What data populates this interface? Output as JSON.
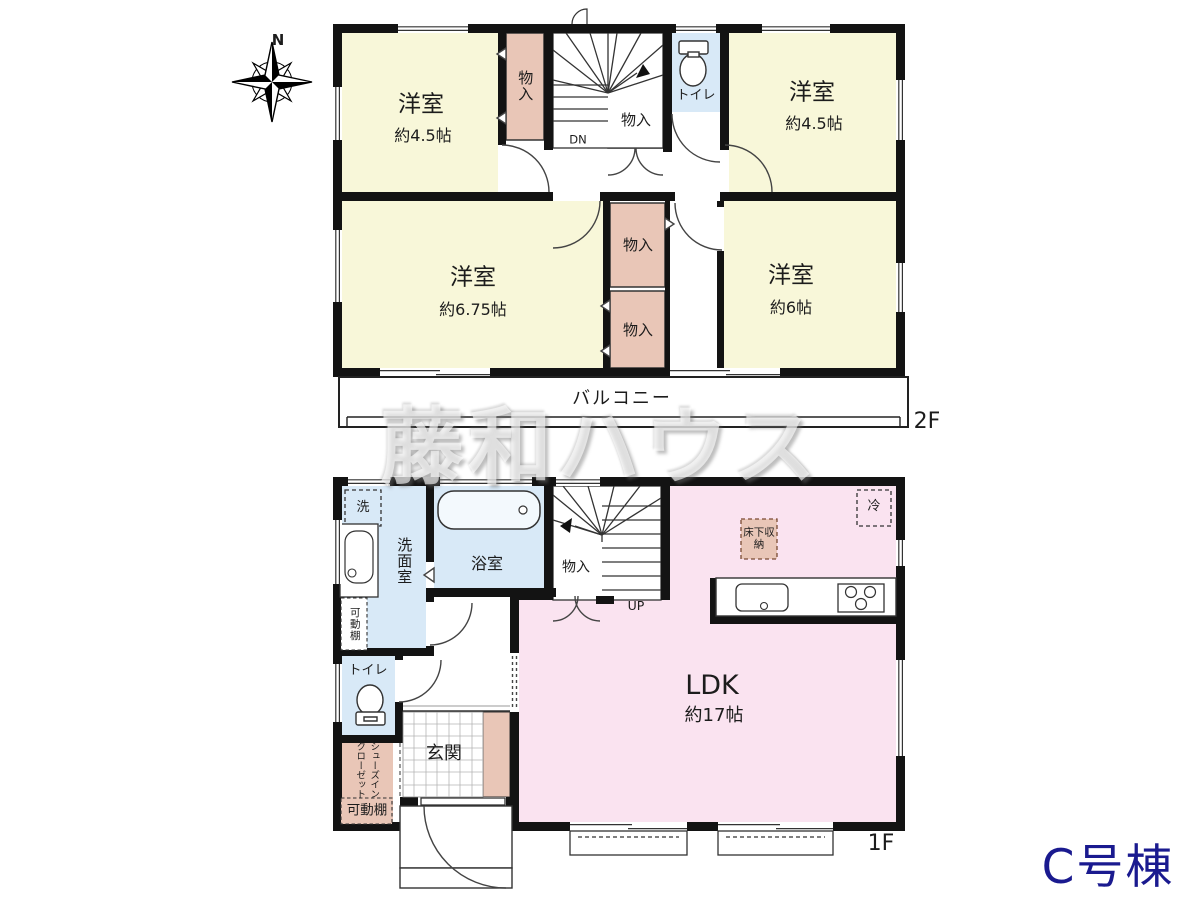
{
  "compass": {
    "north_label": "N"
  },
  "watermark": {
    "text": "藤和ハウス"
  },
  "building": {
    "label": "C号棟"
  },
  "floor2": {
    "label": "2F",
    "balcony": "バルコニー",
    "stairs": "DN",
    "toilet": "トイレ",
    "rooms": [
      {
        "name": "洋室",
        "size": "約4.5帖"
      },
      {
        "name": "洋室",
        "size": "約4.5帖"
      },
      {
        "name": "洋室",
        "size": "約6.75帖"
      },
      {
        "name": "洋室",
        "size": "約6帖"
      }
    ],
    "closets": [
      "物入",
      "物入",
      "物入",
      "物入"
    ]
  },
  "floor1": {
    "label": "1F",
    "stairs": "UP",
    "ldk": {
      "name": "LDK",
      "size": "約17帖"
    },
    "washroom": "洗面室",
    "washer": "洗",
    "bathroom": "浴室",
    "closet": "物入",
    "toilet": "トイレ",
    "entrance": "玄関",
    "shoe_closet_line1": "シューズイン",
    "shoe_closet_line2": "クローゼット",
    "shelf_washroom": "可動棚",
    "shelf_entrance": "可動棚",
    "underfloor_storage": "床下収納",
    "refrigerator": "冷"
  },
  "colors": {
    "room_yellow": "#f8f7d9",
    "closet_salmon": "#e9c6b7",
    "wet_area_blue": "#d8e9f7",
    "ldk_pink": "#fae3f0",
    "wall_black": "#131313",
    "brand_navy": "#1a1a8f"
  }
}
